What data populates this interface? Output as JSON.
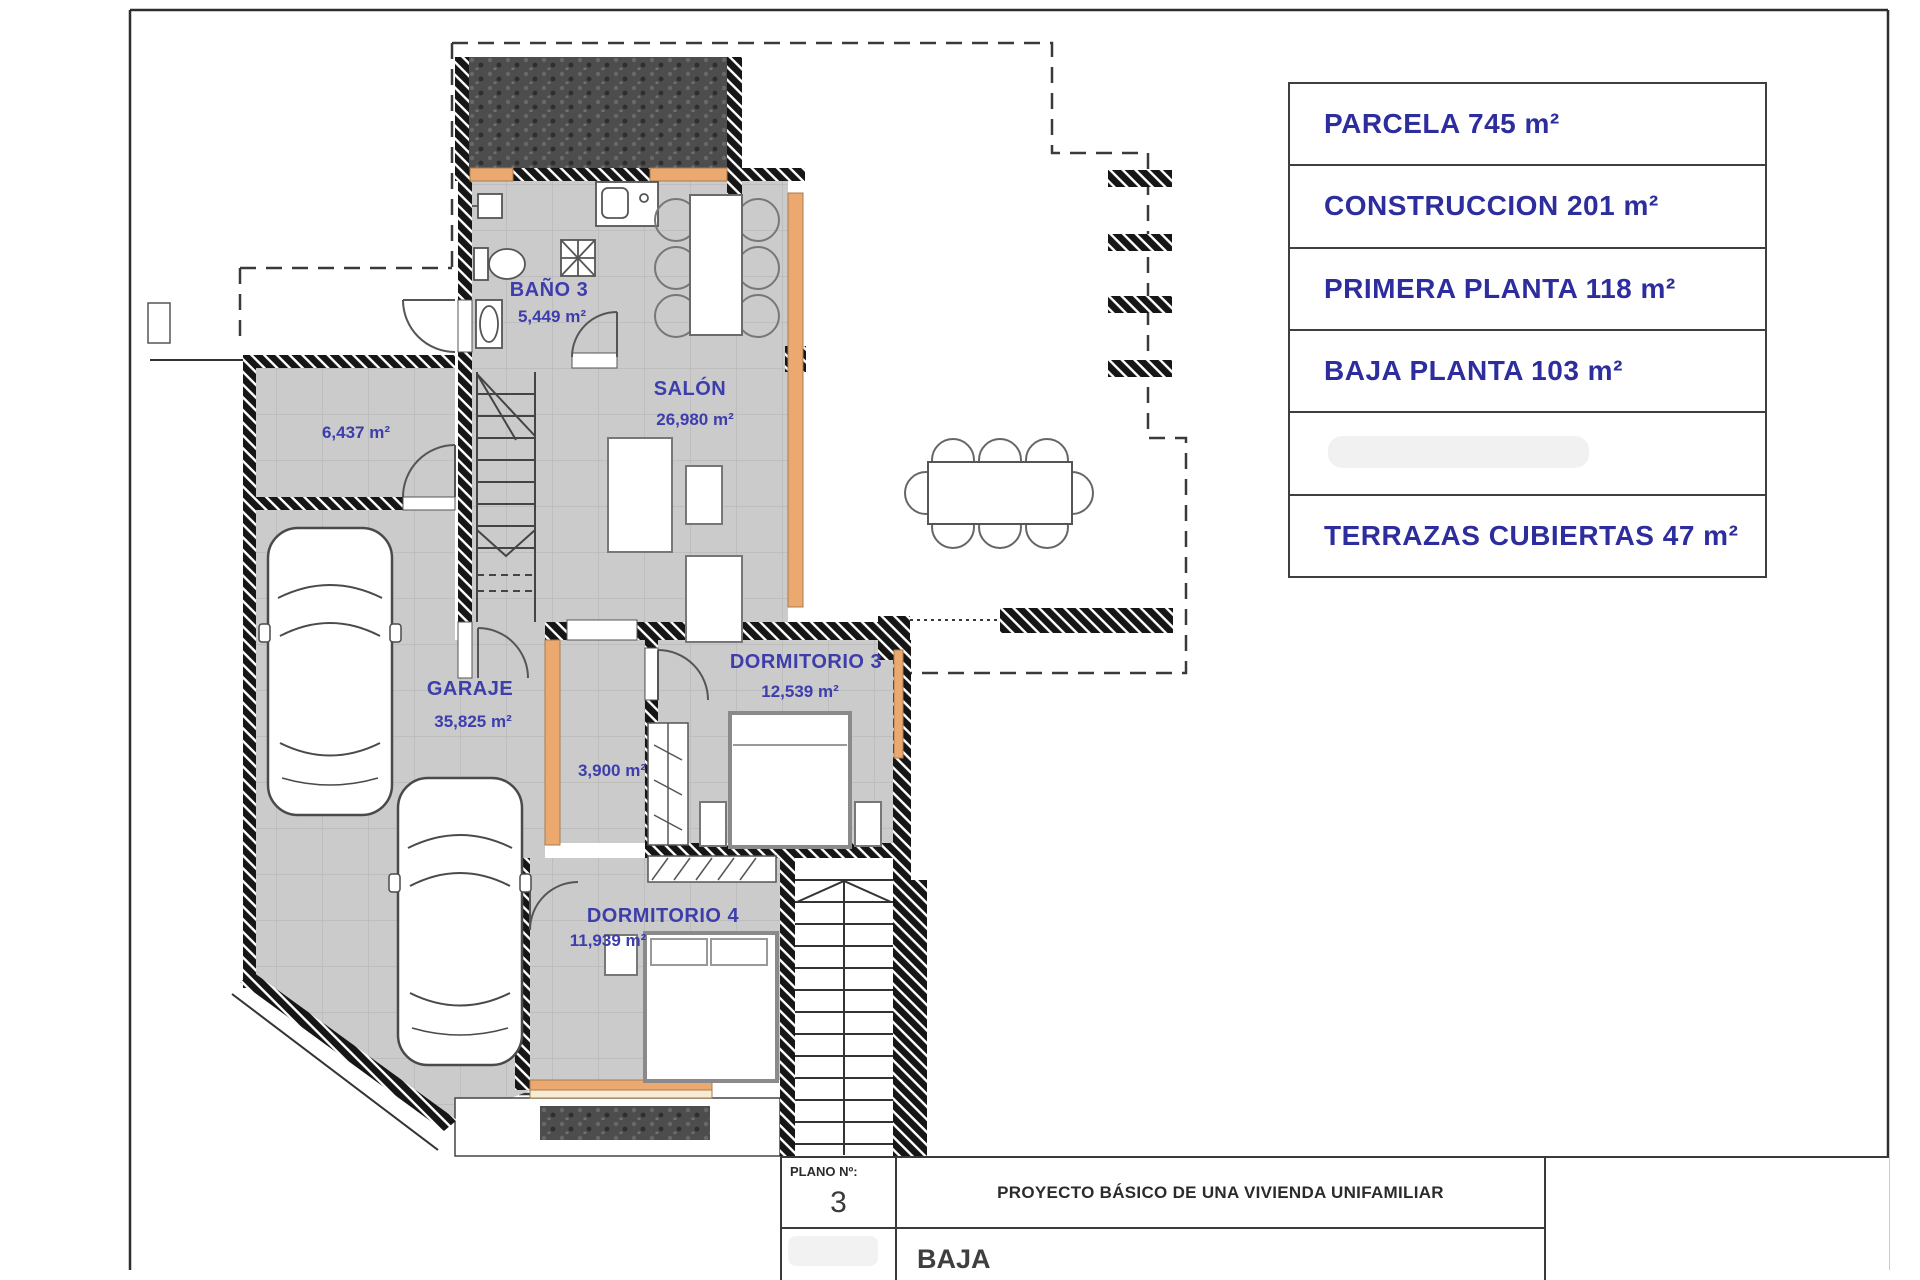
{
  "sheet": {
    "legend": {
      "rows": [
        "PARCELA 745 m²",
        "CONSTRUCCION 201 m²",
        "PRIMERA PLANTA 118 m²",
        "BAJA PLANTA 103 m²",
        "",
        "TERRAZAS CUBIERTAS 47 m²"
      ]
    },
    "title_block": {
      "plano_label": "PLANO Nº:",
      "plano_number": "3",
      "project_title": "PROYECTO BÁSICO DE UNA VIVIENDA UNIFAMILIAR",
      "floor_name": "BAJA"
    }
  },
  "plan": {
    "rooms": [
      {
        "name": "BAÑO 3",
        "area": "5,449 m²"
      },
      {
        "name": "SALÓN",
        "area": "26,980 m²"
      },
      {
        "name": "",
        "area": "6,437 m²"
      },
      {
        "name": "GARAJE",
        "area": "35,825 m²"
      },
      {
        "name": "",
        "area": "3,900 m²"
      },
      {
        "name": "DORMITORIO 3",
        "area": "12,539 m²"
      },
      {
        "name": "DORMITORIO 4",
        "area": "11,939 m²"
      }
    ]
  },
  "colors": {
    "label_blue": "#3d3dac",
    "legend_blue": "#2d2d9e",
    "wall_black": "#161616",
    "window_orange": "#eba96f",
    "sill_cream": "#f7ecd2",
    "floor_gray": "#cbcbcb",
    "stone_dark": "#4d4d4d"
  }
}
